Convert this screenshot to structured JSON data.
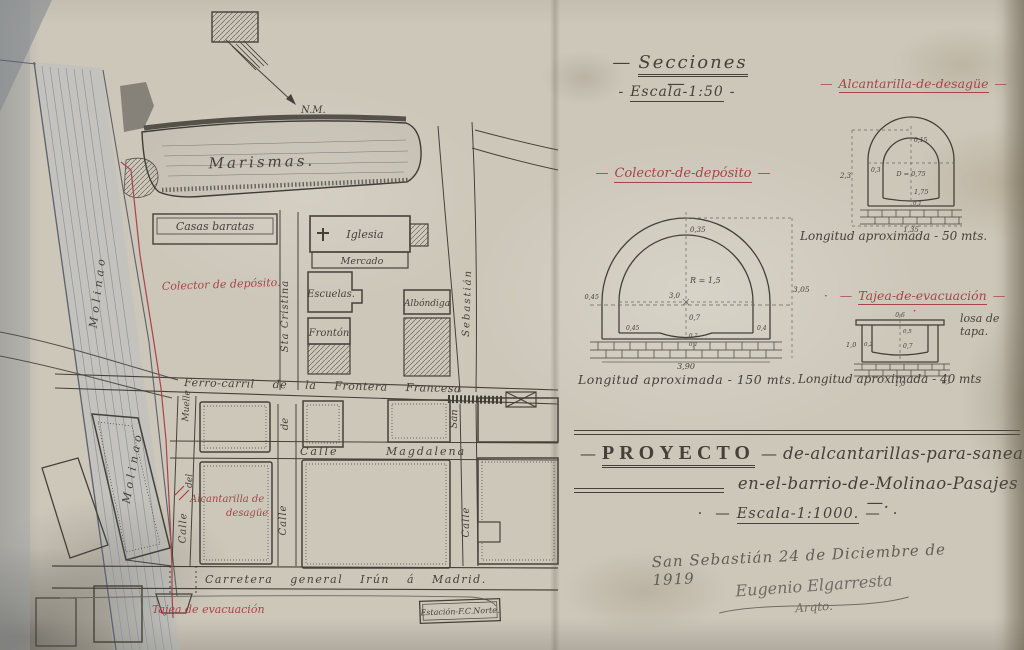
{
  "ui": {
    "dash": "—",
    "hyph": "-",
    "dot": "·"
  },
  "north_label": "N.M.",
  "palette": {
    "paper": "#cdc7ba",
    "ink": "#45413a",
    "red": "#a84449",
    "wash": "#93a0ac",
    "faded_ink": "#6e6c64"
  },
  "map": {
    "marismas": "Marismas.",
    "casas_baratas": "Casas baratas",
    "iglesia": "Iglesia",
    "mercado": "Mercado",
    "escuelas": "Escuelas.",
    "fronton": "Frontón",
    "albondiga": "Albóndiga",
    "sta_cristina": "Sta Cristina",
    "san": "San",
    "sebastian": "Sebastián",
    "calle": "Calle",
    "de": "de",
    "del": "del",
    "muelle": "Muelle",
    "molinao": "Molinao",
    "ferrocarril": "Ferro-carril de la Frontera Francesa",
    "magdalena": "Calle Magdalena",
    "carretera": "Carretera general Irún á Madrid.",
    "estacion": "Estación-F.C.Norte.",
    "colector_label": "Colector de depósito.",
    "alcantarilla_label_1": "Alcantarilla de",
    "alcantarilla_label_2": "desagüe",
    "tajea_label": "Tajea de evacuación"
  },
  "sections": {
    "heading": "Secciones",
    "scale": "Escala-1:50",
    "colector": {
      "title": "Colector-de-depósito",
      "length": "Longitud aproximada - 150 mts.",
      "dims": {
        "apex": "0,35",
        "radius": "R = 1,5",
        "span": "3,0",
        "drop": "0,7",
        "wall_left": "0,45",
        "bench_left": "0,45",
        "invert": "0,2",
        "base": "0,1",
        "wall_right": "0,4",
        "height": "3,05",
        "width": "3,90"
      }
    },
    "alcantarilla": {
      "title": "Alcantarilla-de-desagüe",
      "length": "Longitud aproximada - 50 mts.",
      "dims": {
        "top": "0,15",
        "wall": "0,3",
        "diameter": "D = 0,75",
        "inner_height": "1,75",
        "total_height": "2,3",
        "base": "0,1",
        "width": "1,35"
      }
    },
    "tajea": {
      "title": "Tajea-de-evacuación",
      "length": "Longitud aproximada - 40 mts",
      "losa": "losa de tapa.",
      "dims": {
        "top": "0,6",
        "inner": "0,5",
        "side": "1,0",
        "wall": "0,2",
        "depth": "0,7",
        "width": "1,0",
        "base": "0,1"
      }
    }
  },
  "title_block": {
    "proyecto": "PROYECTO",
    "line1": "de-alcantarillas-para-saneamiento-",
    "line2": "en-el-barrio-de-Molinao-Pasajes —.",
    "escala": "Escala-1:1000.",
    "place_date": "San Sebastián 24 de Diciembre de 1919",
    "signature": "Eugenio Elgarresta",
    "signer_title": "Arqto."
  }
}
